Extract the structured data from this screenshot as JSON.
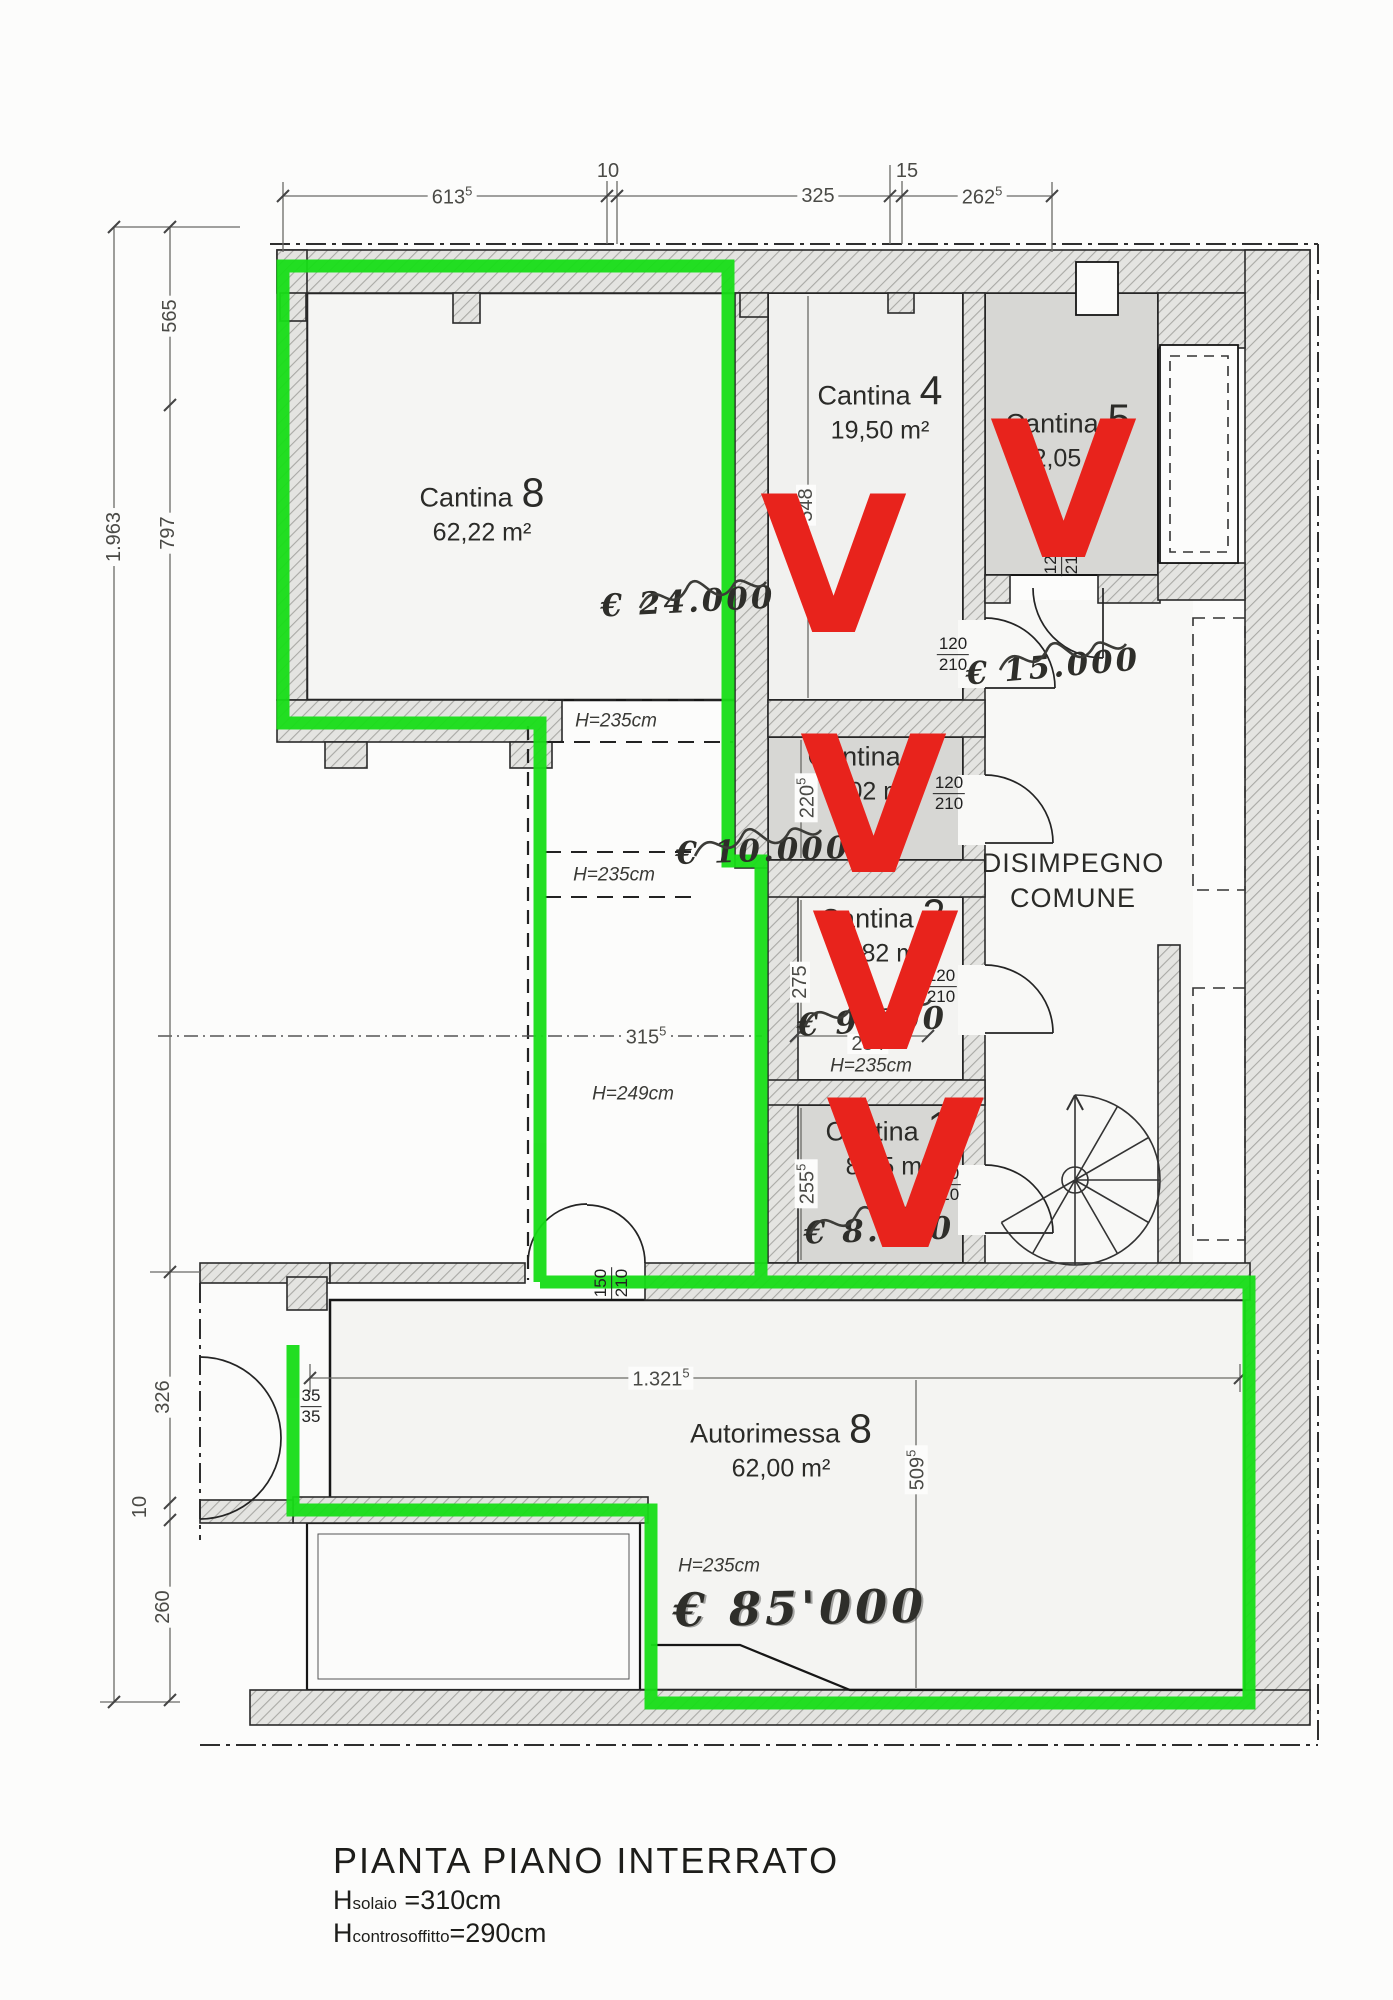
{
  "colors": {
    "highlight_green": "#17dd17",
    "check_red": "#e8231c",
    "wall_line": "#2a2a2a"
  },
  "title": {
    "main": "PIANTA PIANO INTERRATO",
    "h1_prefix": "H",
    "h1_sub": "solaio",
    "h1_value": " =310cm",
    "h2_prefix": "H",
    "h2_sub": "controsoffitto",
    "h2_value": "=290cm"
  },
  "corridor": {
    "line1": "DISIMPEGNO",
    "line2": "COMUNE"
  },
  "rooms": {
    "cantina8": {
      "label": "Cantina",
      "number": "8",
      "area": "62,22 m²"
    },
    "cantina4": {
      "label": "Cantina",
      "number": "4",
      "area": "19,50 m²",
      "price": "€ 24.000"
    },
    "cantina5": {
      "label": "Cantina",
      "number": "5",
      "area": "12,05 m²",
      "price": "€ 15.000"
    },
    "cantina3": {
      "label": "Cantina",
      "number": "3",
      "area": "6,02 m²",
      "price": "€ 10.000"
    },
    "cantina2": {
      "label": "Cantina",
      "number": "2",
      "area": "6,82 m²",
      "price": "€ 9.000"
    },
    "cantina1": {
      "label": "Cantina",
      "number": "1",
      "area": "8,45 m²",
      "price": "€ 8.000"
    },
    "autorimessa": {
      "label": "Autorimessa",
      "number": "8",
      "area": "62,00 m²",
      "price": "€ 85'000"
    }
  },
  "heights": {
    "upper": "H=235cm",
    "middle": "H=235cm",
    "lower": "H=249cm",
    "cantina2": "H=235cm",
    "garage": "H=235cm"
  },
  "dims": {
    "top_613": {
      "v": "613",
      "s": "5"
    },
    "top_10": {
      "v": "10"
    },
    "top_325": {
      "v": "325"
    },
    "top_15": {
      "v": "15"
    },
    "top_262": {
      "v": "262",
      "s": "5"
    },
    "left_total": {
      "v": "1.963"
    },
    "left_565": {
      "v": "565"
    },
    "left_797": {
      "v": "797"
    },
    "left_326": {
      "v": "326"
    },
    "left_10": {
      "v": "10"
    },
    "left_260": {
      "v": "260"
    },
    "in_548": {
      "v": "548"
    },
    "in_220": {
      "v": "220",
      "s": "5"
    },
    "in_275": {
      "v": "275"
    },
    "in_254": {
      "v": "254"
    },
    "in_255": {
      "v": "255",
      "s": "5"
    },
    "in_315": {
      "v": "315",
      "s": "5"
    },
    "in_1321": {
      "v": "1.321",
      "s": "5"
    },
    "in_509": {
      "v": "509",
      "s": "5"
    }
  },
  "doors": {
    "c4": {
      "w": "120",
      "h": "210"
    },
    "c5": {
      "w": "120",
      "h": "210"
    },
    "c3": {
      "w": "120",
      "h": "210"
    },
    "c2": {
      "w": "120",
      "h": "210"
    },
    "c1": {
      "w": "120",
      "h": "210"
    },
    "garage": {
      "w": "150",
      "h": "210"
    },
    "entry": {
      "w": "35",
      "h": "35"
    }
  },
  "annotations": {
    "check1": "V",
    "check2": "V",
    "check3": "V",
    "check4": "V",
    "check5": "V"
  }
}
